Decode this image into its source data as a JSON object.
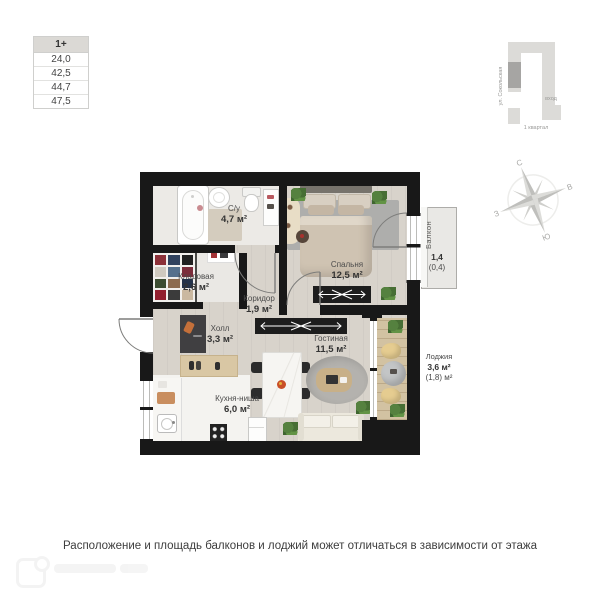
{
  "info_table": {
    "header": "1+",
    "rows": [
      "24,0",
      "42,5",
      "44,7",
      "47,5"
    ]
  },
  "site_plan": {
    "street": "ул. Сокольская",
    "entrance_label": "вход",
    "block_label": "1 квартал",
    "highlight_color": "#a6a5a3",
    "block_color": "#dcdbd8"
  },
  "compass": {
    "north": "С",
    "east": "В",
    "south": "Ю",
    "west": "З"
  },
  "rooms": [
    {
      "id": "bathroom",
      "name": "С/у",
      "area": "4,7 м²"
    },
    {
      "id": "storage",
      "name": "Кладовая",
      "area": "2,6 м²"
    },
    {
      "id": "corridor",
      "name": "Коридор",
      "area": "1,9 м²"
    },
    {
      "id": "hall",
      "name": "Холл",
      "area": "3,3 м²"
    },
    {
      "id": "bedroom",
      "name": "Спальня",
      "area": "12,5 м²"
    },
    {
      "id": "living",
      "name": "Гостиная",
      "area": "11,5 м²"
    },
    {
      "id": "kitchen",
      "name": "Кухня-ниша",
      "area": "6,0 м²"
    },
    {
      "id": "balcony",
      "name": "Балкон",
      "area": "1,4",
      "area2": "(0,4)"
    },
    {
      "id": "loggia",
      "name": "Лоджия",
      "area": "3,6 м²",
      "area2": "(1,8) м²"
    }
  ],
  "disclaimer": "Расположение и площадь балконов и лоджий может отличаться в зависимости от этажа",
  "colors": {
    "wall": "#181818",
    "wood_floor": "#d8d3cb",
    "tile_floor": "#eceae6",
    "loggia_floor": "#d2c2a2",
    "plant_green": "#55813f"
  }
}
